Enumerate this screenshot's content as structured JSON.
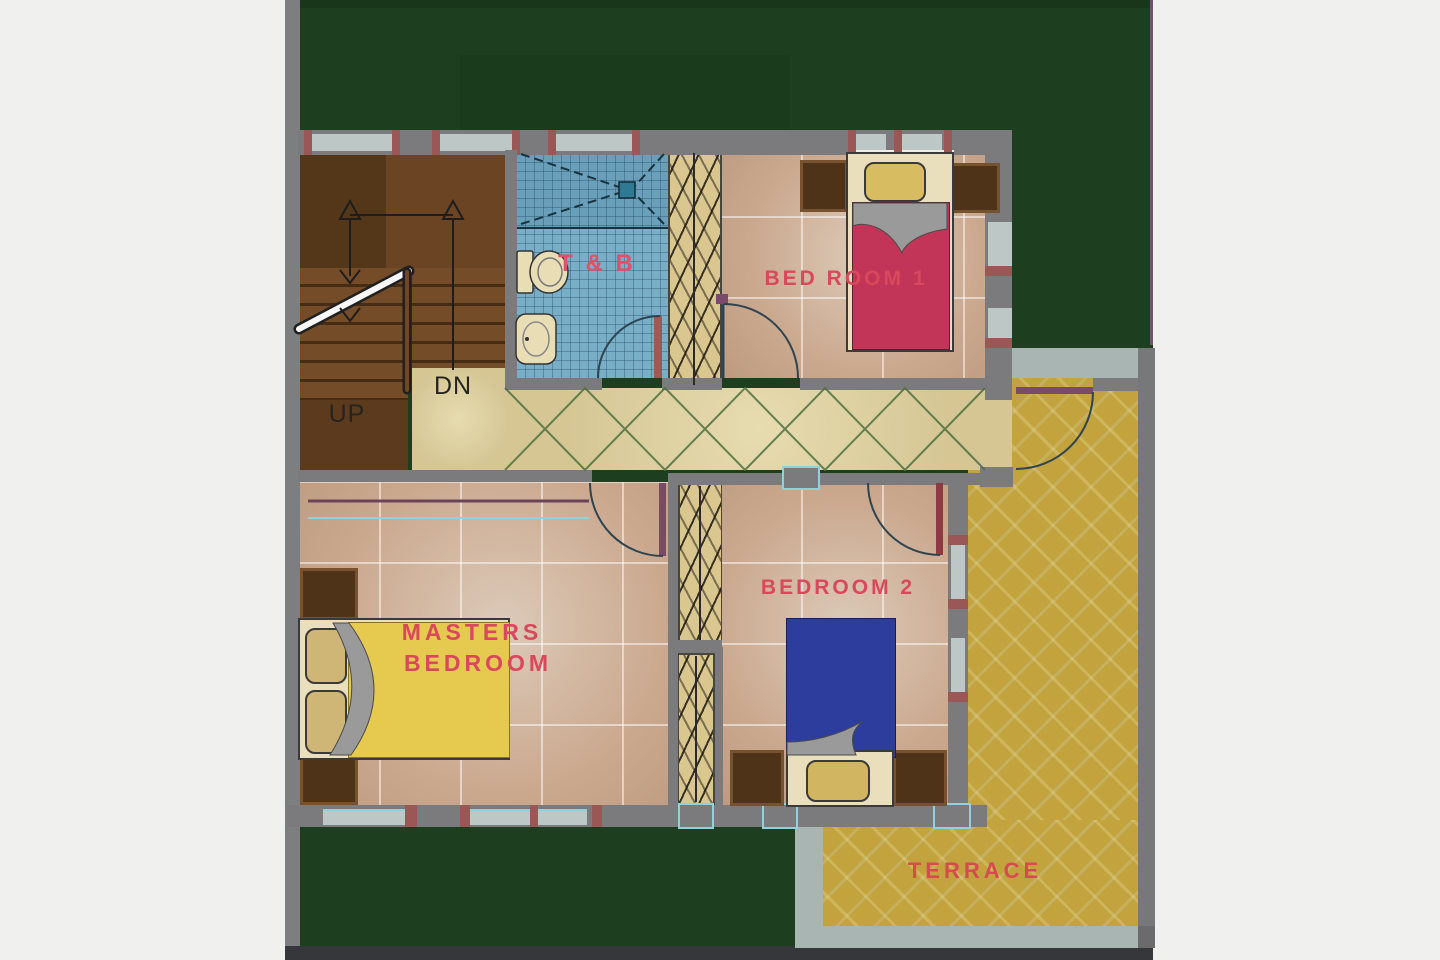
{
  "plan": {
    "kind": "residential floor plan (upper floor)",
    "rooms": {
      "toilet_bath": {
        "label": "T & B"
      },
      "bedroom1": {
        "label": "BED ROOM 1"
      },
      "masters_bedroom": {
        "label_line1": "MASTERS",
        "label_line2": "BEDROOM"
      },
      "bedroom2": {
        "label": "BEDROOM 2"
      },
      "terrace": {
        "label": "TERRACE"
      }
    },
    "stairs": {
      "up_label": "UP",
      "down_label": "DN"
    },
    "palette": {
      "page_margin": "#f0f0ee",
      "lot_green": "#1d3e1f",
      "wall_gray": "#7b7b7d",
      "window_light": "#bcc7c6",
      "window_cyan_trim": "#8fd2dc",
      "stud_red": "#9b5656",
      "bedroom_floor_tan": "#cba98f",
      "hallway_cream": "#ddd0a4",
      "hallway_x_green": "#4e7040",
      "bath_tile_blue": "#79aec7",
      "closet_tan": "#d9c78f",
      "stair_brown": "#6f4724",
      "terrace_gold": "#c2a33e",
      "terrace_ledge_gray": "#a9b5b3",
      "bed1_red": "#c23558",
      "masters_bed_yellow": "#e6c94f",
      "bed2_blue": "#2c3d9e",
      "label_red": "#d9485c"
    }
  }
}
